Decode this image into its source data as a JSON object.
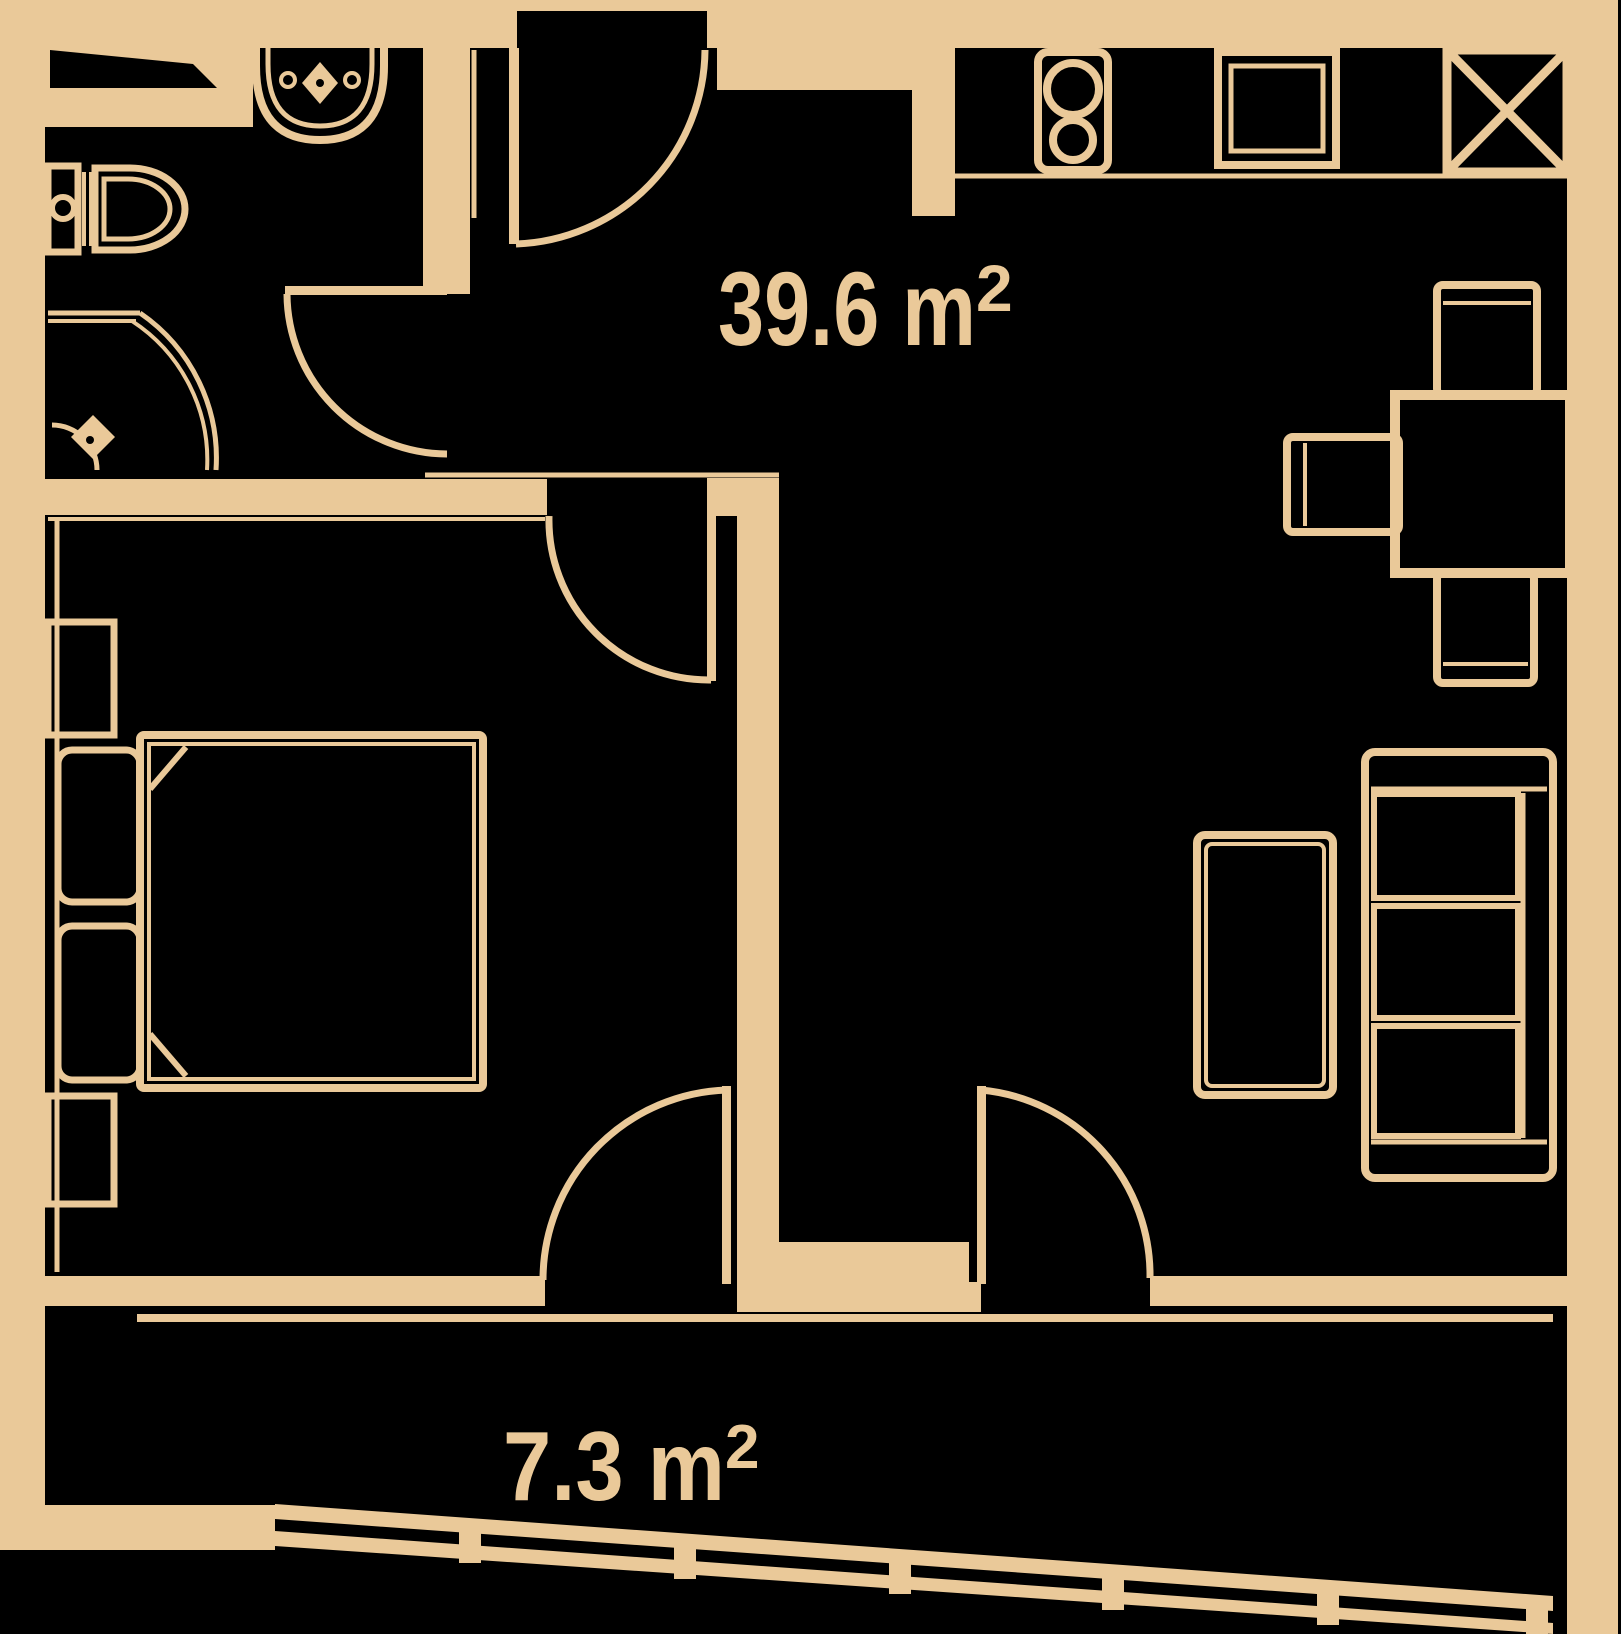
{
  "title": "Apartment floor plan",
  "colors": {
    "background": "#000000",
    "ink": "#eac999"
  },
  "labels": {
    "main_area": {
      "value": "39.6 m",
      "sup": "2"
    },
    "balcony_area": {
      "value": "7.3 m",
      "sup": "2"
    }
  },
  "rooms": [
    {
      "name": "bathroom",
      "fixtures": [
        "vanity-counter",
        "washbasin",
        "faucet",
        "toilet",
        "shower",
        "shower-drain"
      ]
    },
    {
      "name": "bedroom",
      "fixtures": [
        "double-bed",
        "pillow",
        "pillow",
        "nightstand",
        "nightstand"
      ]
    },
    {
      "name": "living-kitchen",
      "area": "39.6 m²",
      "fixtures": [
        "stove",
        "kitchen-sink",
        "fridge",
        "dining-table",
        "chair",
        "chair",
        "chair",
        "sofa",
        "coffee-table"
      ]
    },
    {
      "name": "balcony",
      "area": "7.3 m²",
      "fixtures": [
        "railing",
        "railing-posts"
      ]
    }
  ],
  "doors": [
    "entrance-door",
    "bathroom-door",
    "bedroom-door",
    "bedroom-balcony-door",
    "living-balcony-door"
  ]
}
